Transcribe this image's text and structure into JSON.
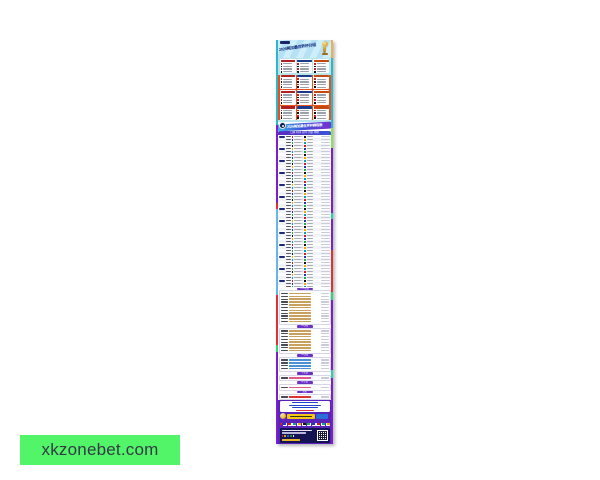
{
  "overlay": {
    "text": "xkzonebet.com",
    "bg_color": "#52f468"
  },
  "poster": {
    "header": {
      "title": "2026美加墨世界杯分组",
      "trophy_icon": "world-cup-trophy"
    },
    "banner": {
      "title": "2026美加墨世界杯赛程表"
    },
    "groups": {
      "count": 12,
      "teams_per_group": 4
    },
    "schedule": {
      "header": "日期 时间 对阵 小组 场地",
      "rows": 52,
      "date_pill_every": 4
    },
    "knockout": [
      {
        "label": "1/16决赛",
        "rows": 11,
        "bar_color": "#c9a05e"
      },
      {
        "label": "1/8决赛",
        "rows": 8,
        "bar_color": "#c9a05e"
      },
      {
        "label": "1/4决赛",
        "rows": 4,
        "bar_color": "#4a90d9"
      },
      {
        "label": "半决赛",
        "rows": 1,
        "bar_color": "#e05a8a"
      },
      {
        "label": "季军赛",
        "rows": 1,
        "bar_color": "#e05a8a"
      },
      {
        "label": "决赛",
        "rows": 1,
        "bar_color": "#e03030"
      }
    ],
    "footer": {
      "notice_lines": 3,
      "flag_count": 10,
      "qr_icon": "qr-code"
    },
    "colors": {
      "frame_purple": "#7a1fd0",
      "group_section_red": "#e8501e",
      "header_blue": "#cdeefb",
      "footer_purple": "#5a23b8",
      "bottom_navy": "#141452",
      "palette": [
        "#c22222",
        "#2233bb",
        "#22aa44",
        "#111111",
        "#eeaa00",
        "#0aa0aa"
      ]
    }
  }
}
